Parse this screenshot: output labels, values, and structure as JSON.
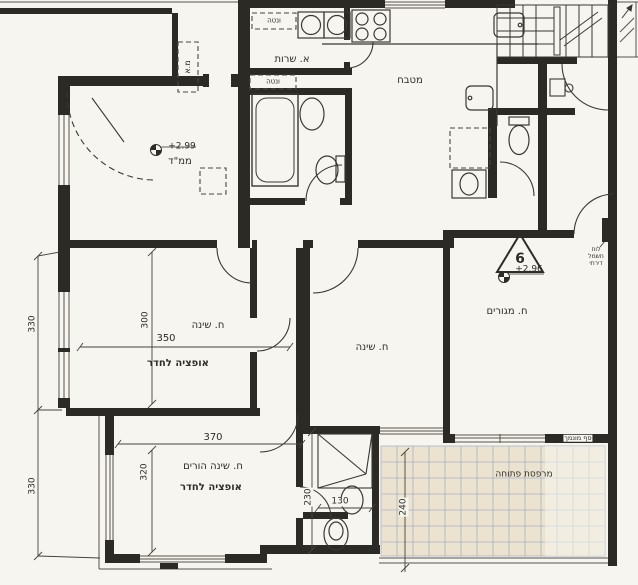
{
  "drawing": {
    "background": "#f7f5ef",
    "ink": "#34322c",
    "tile_fill": "#ebe3d0",
    "tile_line": "#a9b2c4"
  },
  "rooms": {
    "mamad": {
      "label": "ממ\"ד",
      "elevation": "+2.99"
    },
    "service": {
      "label": "א. שרות"
    },
    "kitchen": {
      "label": "מטבח"
    },
    "bedroom1": {
      "label": "ח. שינה",
      "option_note": "אופציה לחדר"
    },
    "bedroom2": {
      "label": "ח. שינה"
    },
    "living": {
      "label": "ח. מגורים",
      "elevation": "+2.96",
      "unit_number": "6"
    },
    "parents": {
      "label": "ח. שינה הורים",
      "option_note": "אופציה לחדר"
    },
    "balcony": {
      "label": "מרפסת פתוחה"
    }
  },
  "annotations": {
    "vent_shaft_top": "ונטה",
    "vent_shaft_mid": "ונטה",
    "ac_niche": "מ.א",
    "water_heater": "ד.נ",
    "lowered_sill": "סף מונמך",
    "panel_lines": [
      "לוח",
      "חשמל",
      "דירתי"
    ]
  },
  "dimensions": {
    "left_upper": "330",
    "left_lower": "330",
    "bedroom1_depth": "300",
    "bedroom1_width": "350",
    "parents_width": "370",
    "parents_depth": "320",
    "shower_depth": "230",
    "shower_width": "130",
    "balcony_depth": "240"
  }
}
